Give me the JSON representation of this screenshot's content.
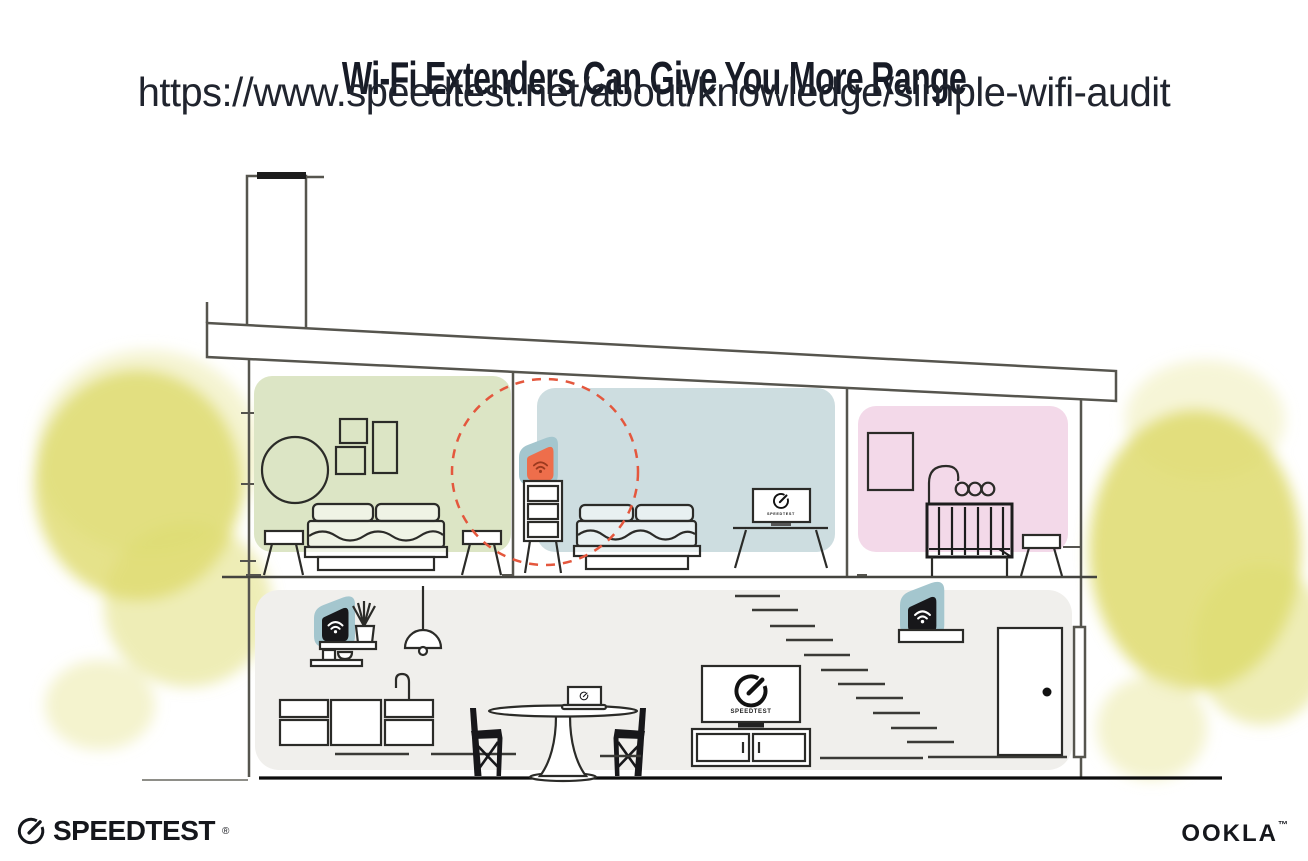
{
  "header": {
    "title": "Wi-Fi Extenders Can Give You More Range",
    "url": "https://www.speedtest.net/about/knowledge/simple-wifi-audit"
  },
  "illustration": {
    "tv_label": "SPEEDTEST",
    "colors": {
      "bedroom_green": "#dce5c5",
      "bedroom_blue": "#cddde0",
      "nursery_pink": "#f3d9e9",
      "ground_floor_gray": "#f0efec",
      "extender_teal": "#a4c6ce",
      "extender_orange": "#ee6e4b",
      "extender_black": "#17171a",
      "wifi_on_orange": "#9c3a1f",
      "wifi_on_black": "#ffffff",
      "range_dash_red": "#e4573d",
      "tree_yellow": "#dedb6d",
      "tree_yellow_light": "#ebe9a6",
      "wall_gray": "#56554e"
    },
    "rooms": [
      {
        "name": "left bedroom",
        "floor": "upper",
        "items": [
          "round mirror",
          "three wall frames",
          "double bed",
          "two stools"
        ]
      },
      {
        "name": "middle bedroom",
        "floor": "upper",
        "items": [
          "dresser with wi-fi extender",
          "dashed range circle",
          "double bed",
          "tv on console"
        ]
      },
      {
        "name": "nursery",
        "floor": "upper",
        "items": [
          "wall frame",
          "baby mobile",
          "crib",
          "stool"
        ]
      },
      {
        "name": "living area",
        "floor": "ground",
        "items": [
          "wall shelves with wi-fi router",
          "plant",
          "pendant lamp",
          "kitchen counter with faucet",
          "dining table with laptop",
          "two chairs",
          "tv on cabinet",
          "staircase with wi-fi extender on shelf",
          "front door"
        ]
      }
    ],
    "extenders": [
      {
        "location": "middle bedroom dresser",
        "style": "orange highlighted with dashed coverage circle"
      },
      {
        "location": "living area wall shelf",
        "style": "black"
      },
      {
        "location": "staircase shelf",
        "style": "black"
      }
    ]
  },
  "footer": {
    "speedtest_label": "SPEEDTEST",
    "speedtest_mark": "®",
    "ookla_label": "OOKLA",
    "ookla_mark": "™"
  }
}
